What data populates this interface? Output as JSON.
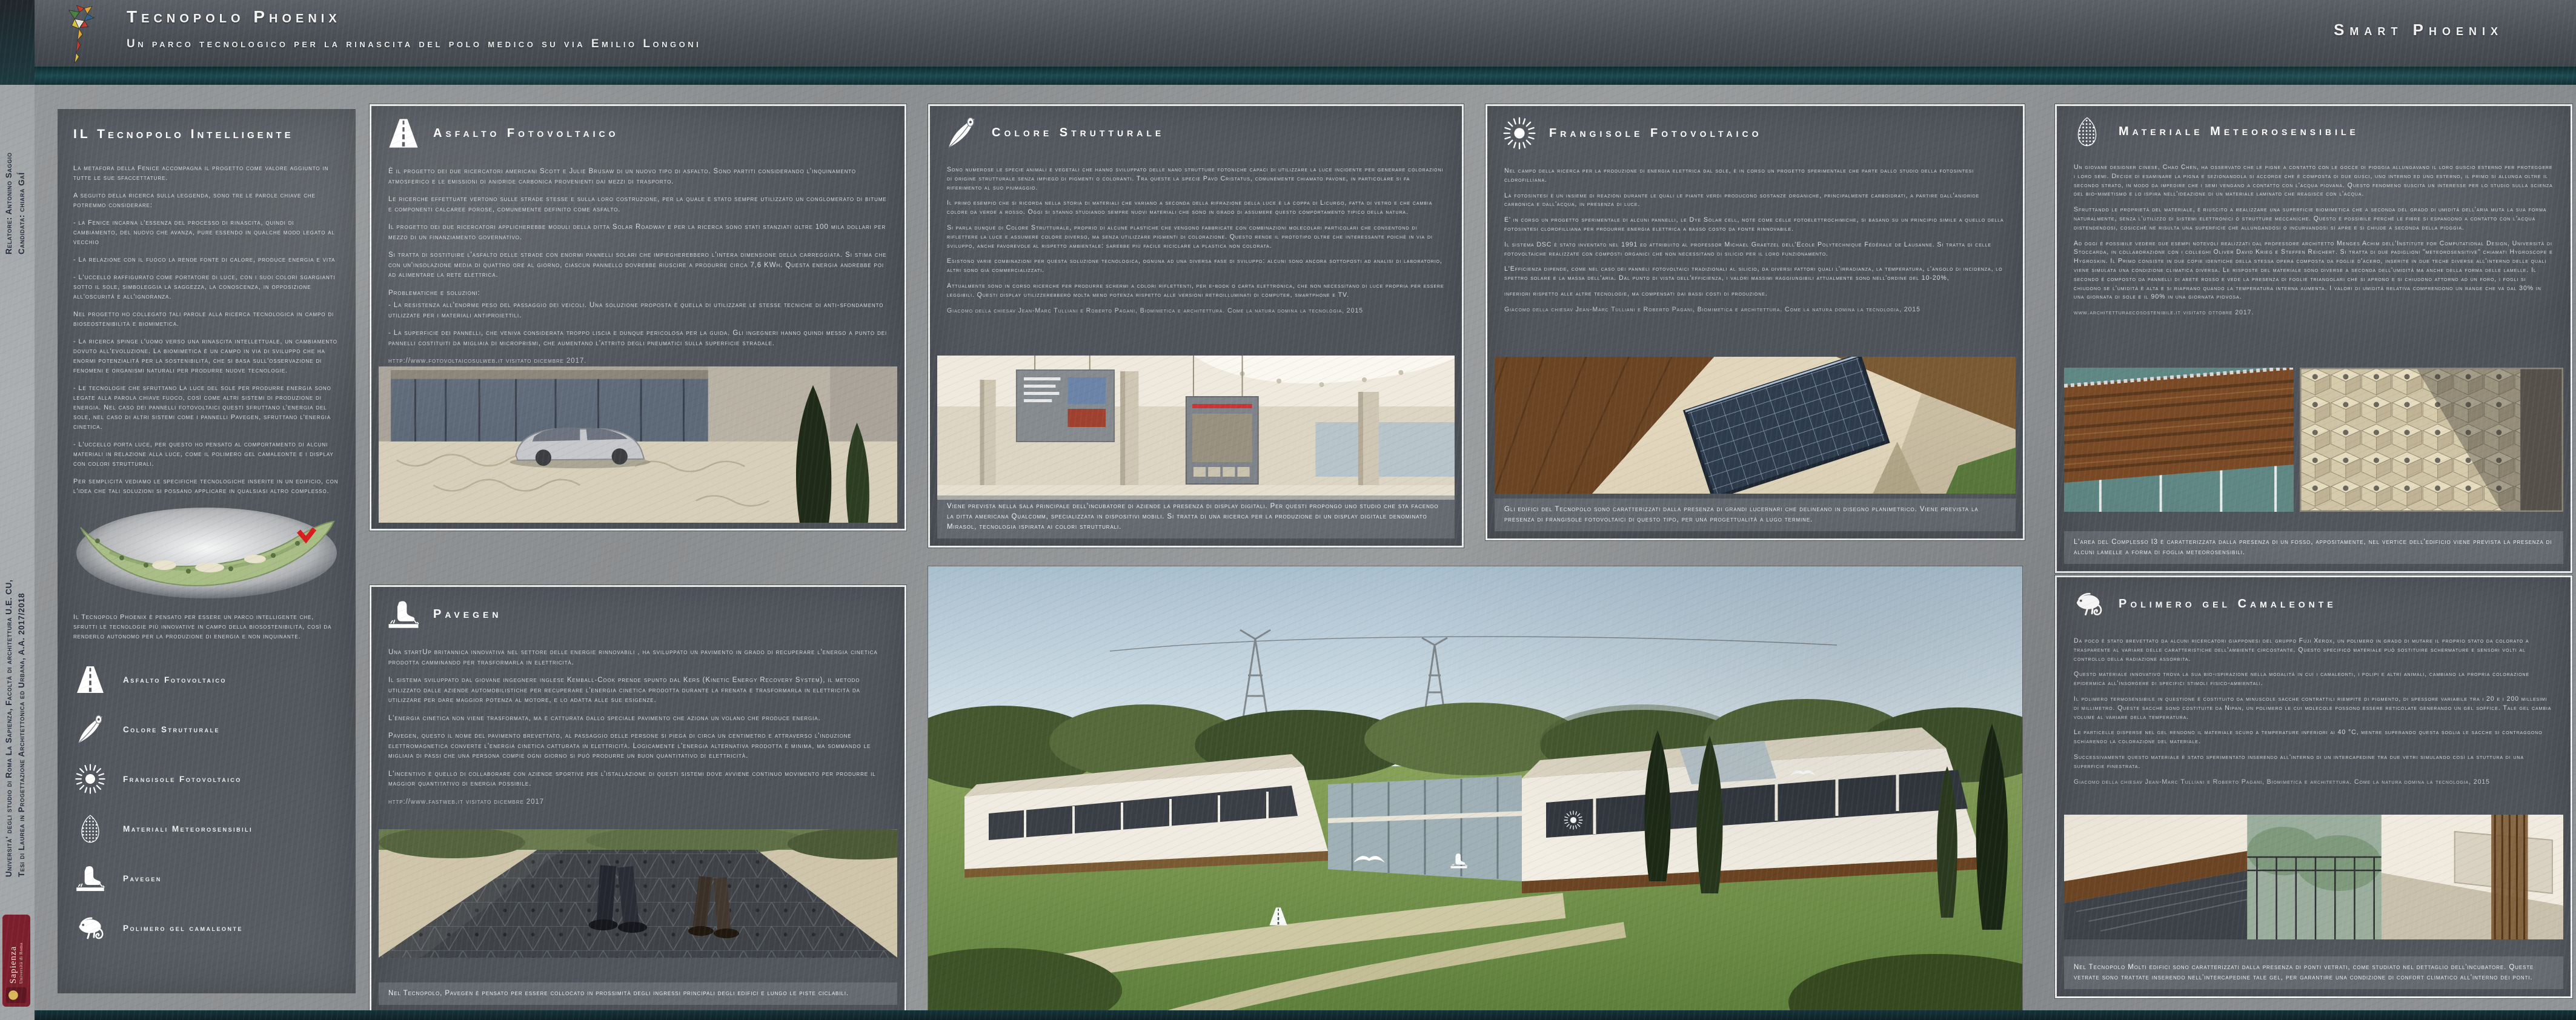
{
  "header": {
    "title": "Tecnopolo Phoenix",
    "subtitle": "Un parco tecnologico per la rinascita del polo medico su via Emilio Longoni",
    "right_title": "Smart Phoenix"
  },
  "sidebar": {
    "line1": "Università' degli studio di Roma La Sapienza, Facoltà di architettura U.E. CU,",
    "line2": "Tesi di Laurea in Progettazione Architettonica ed Urbana, A.A. 2017/2018",
    "relatore": "Relatore: Antonino Saggio",
    "candidata": "Candidata: chiara GaÍ",
    "logo_name": "Sapienza",
    "logo_sub": "Università di Roma"
  },
  "intro": {
    "title": "IL Tecnopolo Intelligente",
    "p": [
      "La metafora della Fenice accompagna il progetto come valore aggiunto in tutte le sue sfaccettature.",
      "A seguito della ricerca sulla leggenda, sono tre le parole chiave che potremmo considerare:",
      "- la Fenice incarna l'essenza del processo di rinascita, quindi di cambiamento, del nuovo che avanza, pure essendo in qualche modo legato al vecchio",
      "- La relazione con il fuoco la rende fonte di calore, produce energia e vita",
      "- L'uccello raffigurato come portatore di luce, con i suoi colori sgargianti sotto il sole, simboleggia la saggezza, la conoscenza, in opposizione all'oscurità e all'ignoranza.",
      "Nel progetto ho collegato tali parole alla ricerca tecnologica in campo di bioseostenibilità e biomimetica.",
      "- La ricerca spinge l'uomo verso una rinascita intellettuale, un cambiamento dovuto all'evoluzione. La biomimetica è un campo in via di sviluppo che ha enormi potenzialità per la sostenibilità, che si basa sull'osservazione di fenomeni e organismi naturali per produrre nuove tecnologie.",
      "- Le tecnologie che sfruttano La luce del sole per produrre energia sono legate alla parola chiave fuoco, così come altri sistemi di produzione di energia. Nel caso dei pannelli fotovoltaici questi sfruttano l'energia del sole, nel caso di altri sistemi come i pannelli Pavegen, sfruttano l'energia cinetica.",
      "- L'uccello porta luce, per questo ho pensato al comportamento di alcuni materiali in relazione alla luce, come il polimero gel camaleonte e i display con colori strutturali.",
      "Per semplicità vediamo le specifiche tecnologiche inserite in un edificio, con l'idea che tali soluzioni si possano applicare in qualsiasi altro complesso."
    ],
    "map_caption": "Il Tecnopolo Phoenix è pensato per essere un parco intelligente che, sfrutti le tecnologie più innovative in campo della biosostenibilità, così da renderlo autonomo per la produzione di energia e non inquinante.",
    "legend": [
      {
        "icon": "road-icon",
        "label": "Asfalto Fotovoltaico"
      },
      {
        "icon": "feather-icon",
        "label": "Colore Strutturale"
      },
      {
        "icon": "sun-icon",
        "label": "Frangisole Fotovoltaico"
      },
      {
        "icon": "pinecone-icon",
        "label": "Materiali Meteorosensibili"
      },
      {
        "icon": "footstep-icon",
        "label": "Pavegen"
      },
      {
        "icon": "chameleon-icon",
        "label": "Polimero gel camaleonte"
      }
    ]
  },
  "panels": {
    "asfalto": {
      "title": "Asfalto Fotovoltaico",
      "p": [
        "È il progetto dei due ricercatori americani Scott e Julie Brusaw di un nuovo tipo di asfalto. Sono partiti considerando l'inquinamento atmosferico e le emissioni di anidride carbonica provenienti dai mezzi di trasporto.",
        "Le ricerche effettuate vertono sulle strade stesse e sulla loro costruzione, per la quale è stato sempre utilizzato un conglomerato di bitume e componenti calcaree porose, comunemente definito come asfalto.",
        "Il progetto dei due ricercatori applicherebbe moduli della ditta Solar Roadway e per la ricerca sono stati stanziati oltre 100 mila dollari per mezzo di un finanziamento governativo.",
        "Si tratta di sostituire l'asfalto delle strade con enormi pannelli solari che impiegherebbero l'intera dimensione della carreggiata. Si stima che con un'insolazione media di quattro ore al giorno, ciascun pannello dovrebbe riuscire a produrre circa 7,6 KWh. Questa energia andrebbe poi ad alimentare la rete elettrica.",
        "Problematiche e soluzioni:",
        "- La resistenza all'enorme peso del passaggio dei veicoli. Una soluzione proposta è quella di utilizzare le stesse tecniche di anti-sfondamento utilizzate per i materiali antiproiettili.",
        "- La superficie dei pannelli, che veniva considerata troppo liscia e dunque pericolosa per la guida. Gli ingegneri hanno quindi messo a punto dei pannelli costituiti da migliaia di microprismi, che aumentano l'attrito degli pneumatici sulla superficie stradale."
      ],
      "source": "http://www.fotovoltaicosulweb.it  visitato dicembre 2017."
    },
    "pavegen": {
      "title": "Pavegen",
      "p": [
        "Una startUp britannica innovativa nel settore delle energie rinnovabili , ha sviluppato un pavimento in grado di recuperare l'energia cinetica prodotta camminando per trasformarla in elettricità.",
        "Il sistema sviluppato dal giovane ingegnere inglese Kemball-Cook prende spunto dal Kers (Kinetic Energy Recovery System), il metodo utilizzato dalle aziende automobilistiche per recuperare l'energia cinetica prodotta durante la frenata e trasformarla in elettricità da utilizzare per dare maggior potenza al motore, e lo adatta alle sue esigenze.",
        "L'energia cinetica non viene trasformata, ma è catturata dallo speciale pavimento che aziona un volano che produce energia.",
        "Pavegen, questo il nome del pavimento brevettato, al passaggio delle persone si piega di circa un centimetro e attraverso l'induzione elettromagnetica converte l'energia cinetica catturata in elettricità. Logicamente l'energia alternativa prodotta è minima, ma sommando le migliaia di passi che una persona compie ogni giorno si può produrre un buon quantitativo di elettricità.",
        "L'incentivo è quello di collaborare con aziende sportive per l'istallazione di questi sistemi dove avviene continuo movimento per produrre il maggior quantitativo di energia possibile."
      ],
      "source": "http://www.fastweb.it visitato dicembre 2017",
      "caption": "Nel Tecnopolo, Pavegen è pensato per essere collocato in prossimità degli ingressi principali degli edifici e lungo le piste ciclabili."
    },
    "colore": {
      "title": "Colore Strutturale",
      "p": [
        "Sono numerose le specie animali e vegetali che hanno sviluppato delle nano strutture fotoniche capaci di utilizzare la luce incidente per generare colorazioni di origine strutturale senza impiego di pigmenti o coloranti. Tra queste la specie Pavo Cristatus, comunemente chiamato pavone, in particolare si fa riferimento al suo piumaggio.",
        "Il primo esempio che si ricorda nella storia di materiali che variano a seconda della rifrazione della luce è la coppa di Licurgo, fatta di vetro e che cambia colore da verde a rosso. Oggi si stanno studiando sempre nuovi materiali che sono in grado di assumere questo comportamento tipico della natura.",
        "Si parla dunque di Colore Strutturale, proprio di alcune plastiche che vengono fabbricate con combinazioni molecolari particolari che consentono di riflettere la luce e assumere colore diverso, ma senza utilizzare pigmenti di colorazione. Questo rende il prototipo oltre che interessante poichè in via di sviluppo, anche favorevole al rispetto ambientale: sarebbe più facile riciclare la plastica non colorata.",
        "Esistono varie combinazioni per questa soluzione tecnologica, ognuna ad una diversa fase di sviluppo: alcuni sono ancora sottoposti ad analisi di laboratorio, altri sono già commercializzati.",
        "Attualmente sono in corso ricerche per produrre schermi a colori riflettenti, per e-book o carta elettronica, che non necessitano di luce propria per essere leggibili. Questi display utilizzerebbero molta meno potenza rispetto alle versioni retroilluminati di computer, smartphone e TV."
      ],
      "source": "Giacomo della chiesav  Jean-Marc Tulliani e Roberto Pagani, Biomimetica e architettura. Come la natura domina la tecnologia, 2015",
      "caption": "Viene prevista nella sala principale dell'incubatore di aziende la presenza di display digitali. Per questi propongo uno studio che sta facendo la ditta americana Qualcomm, specializzata in dispositivi mobili. Si tratta di una ricerca per la produzione di un display digitale denominato Mirasol, tecnologia ispirata ai colori strutturali."
    },
    "frangisole": {
      "title": "Frangisole Fotovoltaico",
      "p": [
        "Nel campo della ricerca per la produzione di energia elettrica dal sole, è in corso un progetto sperimentale che parte dallo studio della fotosintesi clorofilliana.",
        "La fotosintesi è un insieme di reazioni durante le quali le piante verdi producono sostanze organiche, principalmente carboidrati, a partire dall'anidride carbonica e dall'acqua, in presenza di luce.",
        "E' in corso un progetto sperimentale di alcuni pannelli, le Dye Solar cell, note come celle fotoelettrochimiche, si basano su un principio simile a quello della fotosintesi clorofilliana per produrre energia elettrica a basso costo da fonte rinnovabile.",
        "Il sistema DSC è stato inventato nel 1991 ed attribuito al professor Michael Graetzel dell'Ecole Polytechnique Fédérale de Lausanne. Si tratta di celle fotovoltaiche realizzate con composti organici che non necessitano di silicio per il loro funzionamento.",
        "L'Efficienza dipende, come nel caso dei panneli fotovoltaici tradizionali al silicio, da diversi fattori quali l'irradianza, la temperatura, l'angolo di incidenza, lo spettro solare e la massa dell'aria. Dal punto di vista dell'efficienza, i valori massimi raggiungibili attualmente sono nell'ordine del 10-20%,",
        "inferiori rispetto alle altre tecnologie, ma compensati dai bassi costi di produzione."
      ],
      "source": "Giacomo della chiesav  Jean-Marc Tulliani e Roberto Pagani, Biomimetica e architettura. Come la natura domina la tecnologia, 2015",
      "caption": "Gli edifici del Tecnopolo sono caratterizzati dalla presenza di grandi lucernari che delineano in disegno planimetrico. Viene prevista la presenza di frangisole fotovoltaici di questo tipo, per una progettualità a lugo termine."
    },
    "materiale": {
      "title": "Materiale Meteorosensibile",
      "p": [
        "Un giovane designer cinese, Chao Chen, ha osservato che le pigne a contatto con le gocce di pioggia allungavano il loro guscio esterno per proteggere i loro semi. Decide di esaminare la pigna e sezionandola si accorge che è composta di due gusci, uno interno ed uno esterno, il primo si allunga oltre il secondo strato, in modo da impedire che i semi vengano a contatto con l'acqua piovana. Questo fenomeno suscita un interesse per lo studio sulla scienza del bio-mimetismo e lo ispira nell'ideazione di un materiale laminato che reagisce con l'acqua.",
        "Sfruttando le proprietà del materiale, è riuscito a realizzare una superficie biomimetica che a seconda del grado di umidità dell'aria muta la sua forma naturalmente, senza l'utilizzo di sistemi elettronici o strutture meccaniche. Questo è possibile perché le fibre si espandono a contatto con l'acqua distendendosi, cosicché ne risulta una superficie che allungandosi o incurvandosi si apre e si chiude a seconda della pioggia.",
        "Ad oggi è possibile vedere due esempi notevoli realizzati dal professore architetto Menges Achim dell'Institute for Computational Design, Università di Stoccarda, in collaborazione con i colleghi Oliver David Krieg e Steffen Reichert. Si tratta di due padiglioni \"meteorosensitive\" chiamati Hygroscope e Hygroskin. Il Primo consiste in due copie identiche della stessa opera composta da foglie d'acero, inserite in due teche diverse all'interno delle quali viene simulata una condizione climatica diversa. Le risposte del materiale sono diverse a seconda dell'umidità ma anche della forma delle lamelle. Il secondo è composto da pannelli di abete rosso e vede la presenza di foglie triangolari che si aprono e si chiudono attorno ad un foro, i fogli si chiudono se l'umidità è alta e si riaprano quando la temperatura interna aumenta. I valori di umidità relativa comprendono un range che va dal 30% in una giornata di sole e il 90% in una giornata piovosa."
      ],
      "source": "www.architetturaecosostenibile.it visitato ottobre 2017.",
      "caption": "L'area del Complesso I3 è caratterizzata dalla presenza di un fosso, appositamente, nel vertice dell'edificio viene prevista la presenza di alcuni lamelle a forma di foglia meteorosensibili."
    },
    "polimero": {
      "title": "Polimero gel Camaleonte",
      "p": [
        "Da poco è stato brevettato da alcuni ricercatori giapponesi del gruppo Fuji Xerox, un polimero in grado di  mutare il proprio stato da colorato a trasparente al variare delle caratteristiche dell'ambiente circostante. Questo specifico materiale può sostituire schermature e sensori volti al controllo della radiazione assorbita.",
        "Questo materiale innovativo trova la sua bio-ispirazione nella modalità in cui i camaleonti, i polipi e altri animali, cambiano la propria colorazione epidermica all'insorgere di specifici stimoli fisico-ambientali.",
        "Il polimero termosensibile in questione è costituito da minuscole sacche contrattili riempite di pigmento, di spessore variabile tra i 20 e i 200 millesimi di millimetro. Queste sacche sono costituite da Nipan, un polimero le cui molecole possono essere reticolate generando un gel soffice. Tale gel cambia volume al variare della temperatura.",
        "Le particelle disperse nel gel rendono il materiale scuro a temperature inferiori ai 40 °C, mentre superando questa soglia le sacche si contraggono schiarendo la colorazione del materiale.",
        "Successivamente questo materiale è stato sperimentato inserendo all'interno di un intercapedine tra due vetri simulando così la stuttura di una superficie finestrata."
      ],
      "source": "Giacomo della chiesav  Jean-Marc Tulliani e Roberto Pagani, Biomimetica e architettura. Come la natura domina la tecnologia, 2015",
      "caption": "Nel Tecnopolo Molti edifici sono caratterizzati dalla presenza di ponti vetrati, come studiato nel dettaglio dell'incubatore. Queste vetrate sono trattate inserendo nell'intercapedine tale gel, per garantire una condizione di confort climatico all'interno dei ponti."
    }
  },
  "colors": {
    "teal_stripe": "#1d4a50",
    "panel_bg": "#51565c",
    "header_bg": "#4b5056",
    "sapienza_red": "#7b1f2d",
    "text": "#d9dbdc"
  }
}
